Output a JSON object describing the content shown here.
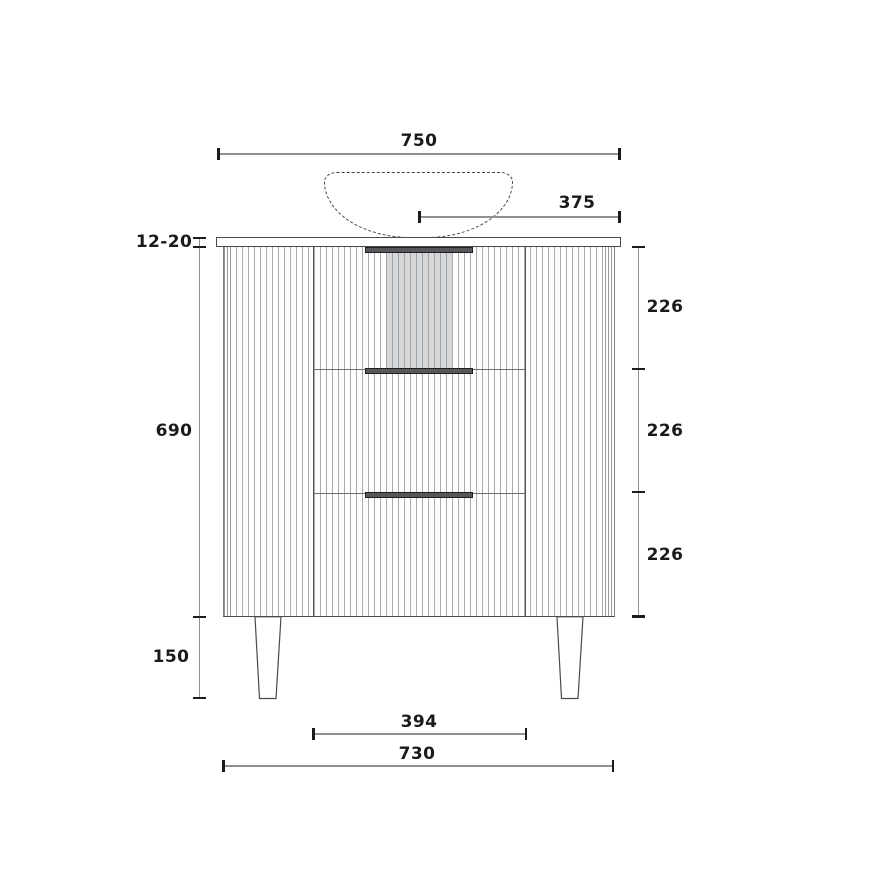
{
  "drawing": {
    "top_width": "750",
    "basin_offset": "375",
    "countertop_thickness": "12-20",
    "cabinet_height": "690",
    "drawer_heights": [
      "226",
      "226",
      "226"
    ],
    "leg_height": "150",
    "leg_span": "394",
    "cabinet_width": "730",
    "colors": {
      "ink": "#1a1a1c",
      "dimension_line": "#8f9194",
      "flute_line": "#a9abae",
      "handle_fill": "#55575a",
      "recess_fill": "#d8d9da",
      "outline": "#4a4a4c"
    }
  }
}
